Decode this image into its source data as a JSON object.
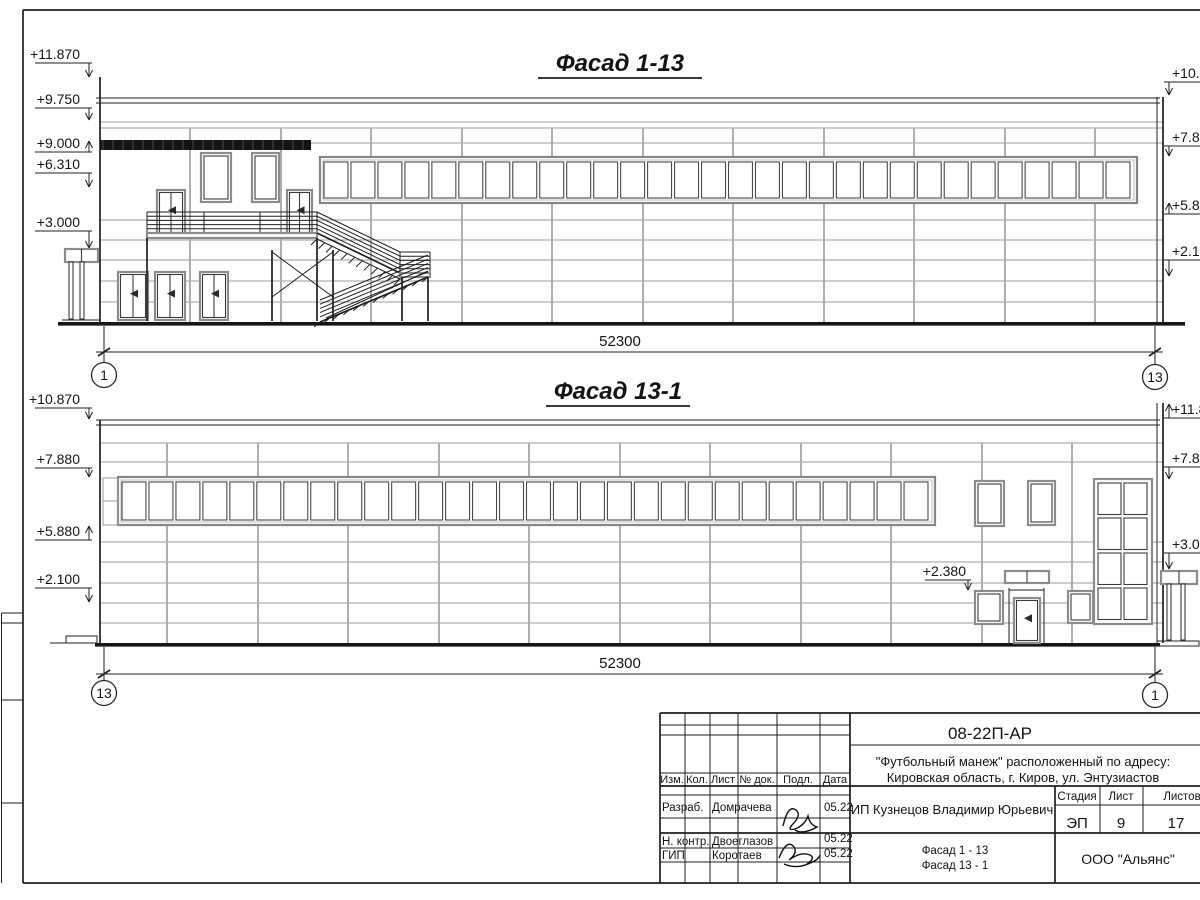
{
  "facade_top": {
    "title": "Фасад 1-13",
    "dimension_total": "52300",
    "axis_left": "1",
    "axis_right": "13",
    "marks_left": [
      "+11.870",
      "+9.750",
      "+9.000",
      "+6.310",
      "+3.000"
    ],
    "marks_right": [
      "+10.870",
      "+7.880",
      "+5.880",
      "+2.100"
    ],
    "window_count": 30
  },
  "facade_bottom": {
    "title": "Фасад 13-1",
    "dimension_total": "52300",
    "axis_left": "13",
    "axis_right": "1",
    "marks_left": [
      "+10.870",
      "+7.880",
      "+5.880",
      "+2.100"
    ],
    "marks_right": [
      "+11.870",
      "+7.880",
      "+3.000"
    ],
    "door_mark": "+2.380",
    "window_count": 30
  },
  "title_block": {
    "doc_code": "08-22П-АР",
    "project_line1": "\"Футбольный манеж\" расположенный по адресу:",
    "project_line2": "Кировская область, г. Киров, ул. Энтузиастов",
    "client": "ИП Кузнецов Владимир Юрьевич",
    "columns": {
      "izm": "Изм.",
      "kol": "Кол.",
      "list": "Лист",
      "doc": "№ док.",
      "podp": "Подл.",
      "date": "Дата"
    },
    "stage_label": "Стадия",
    "sheet_label": "Лист",
    "sheets_label": "Листов",
    "stage": "ЭП",
    "sheet_no": "9",
    "sheets_total": "17",
    "rows": [
      {
        "role": "Разраб.",
        "name": "Домрачева",
        "date": "05.22"
      },
      {
        "role": "Н. контр.",
        "name": "Двоеглазов",
        "date": "05.22"
      },
      {
        "role": "ГИП",
        "name": "Коротаев",
        "date": "05.22"
      }
    ],
    "sheet_title_line1": "Фасад 1 - 13",
    "sheet_title_line2": "Фасад 13 - 1",
    "company": "ООО \"Альянс\""
  }
}
